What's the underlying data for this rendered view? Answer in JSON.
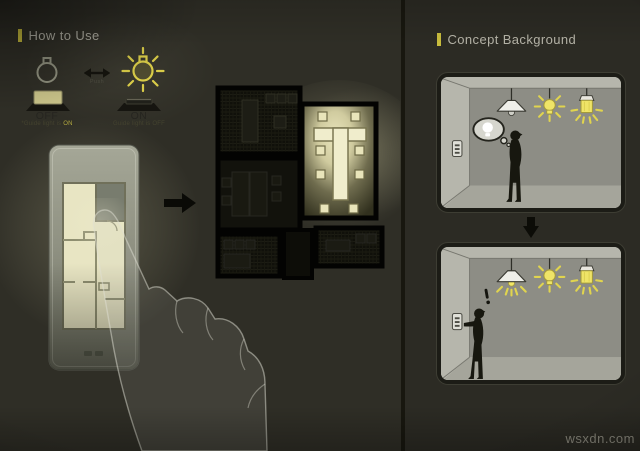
{
  "watermark": "wsxdn.com",
  "colors": {
    "background": "#2f2e26",
    "accent_yellow": "#c9bd3d",
    "glow_cream": "#e8e4c0",
    "lamp_yellow": "#efe467",
    "silhouette_ink": "#17170f",
    "plate_gray": "#999b8c",
    "plan_cream": "#e8e5c3",
    "room_wall_gray": "#8d8d85"
  },
  "how_to_use": {
    "title": "How to Use",
    "bulb_off_icon": "bulb-outline-off",
    "bulb_on_icon": "bulb-glowing-on",
    "swap_arrow_glyph": "↔",
    "push_hint": "Push",
    "off_state": {
      "label": "OFF",
      "caption": "*Guide light is",
      "caption_highlight": "ON"
    },
    "on_state": {
      "label": "ON",
      "caption": "Guide light is",
      "caption_highlight": "OFF"
    },
    "flow_arrow_icon": "right-arrow"
  },
  "concept_background": {
    "title": "Concept Background",
    "panel_top": "person-wondering-about-lights",
    "panel_bottom": "person-pressing-wall-switch",
    "exclamation_mark": "!",
    "down_arrow_icon": "down-arrow"
  }
}
